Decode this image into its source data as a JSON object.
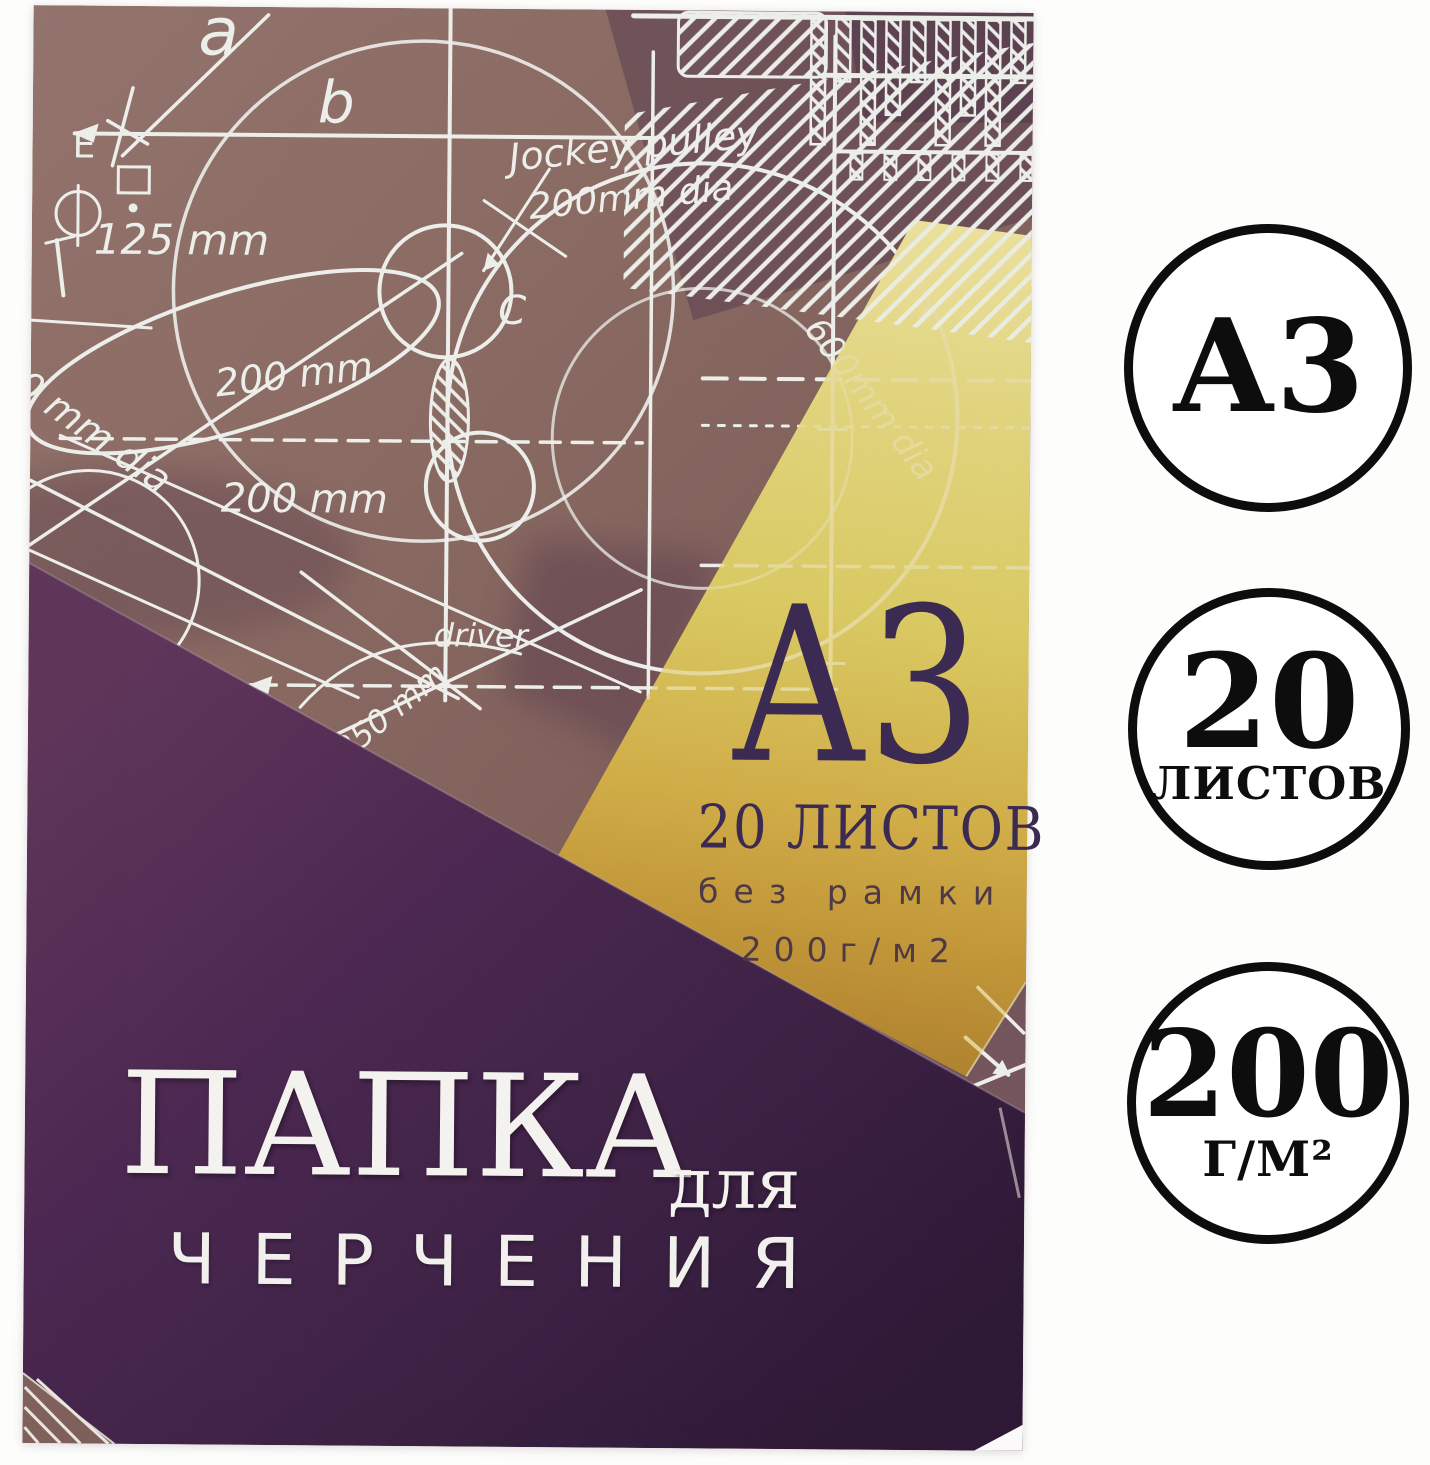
{
  "cover": {
    "format": "А3",
    "sheets": "20 ЛИСТОВ",
    "frame_note": "без рамки",
    "density": "200г/м2",
    "title": "ПАПКА",
    "title_preposition": "для",
    "subtitle": "ЧЕРЧЕНИЯ",
    "sketch_labels": [
      {
        "text": "а"
      },
      {
        "text": "b"
      },
      {
        "text": "E"
      },
      {
        "text": "125 mm"
      },
      {
        "text": "200 mm"
      },
      {
        "text": "200 mm"
      },
      {
        "text": "0 mm dia"
      },
      {
        "text": "C"
      },
      {
        "text": "Jockey pulley"
      },
      {
        "text": "200mm dia"
      },
      {
        "text": "driver"
      },
      {
        "text": "250 mm"
      },
      {
        "text": "600mm dia"
      }
    ],
    "colors": {
      "paper_brown": "#8a6a63",
      "accent_yellow": "#dbcb62",
      "accent_gold": "#b8862c",
      "panel_purple": "#45224a",
      "ink_dark": "#3b2a52",
      "ink_light": "#f4f2ee"
    }
  },
  "badges": [
    {
      "primary": "А3"
    },
    {
      "primary": "20",
      "secondary": "ЛИСТОВ"
    },
    {
      "primary": "200",
      "secondary": "Г/М²"
    }
  ],
  "badge_ring_color": "#0d0d0d"
}
